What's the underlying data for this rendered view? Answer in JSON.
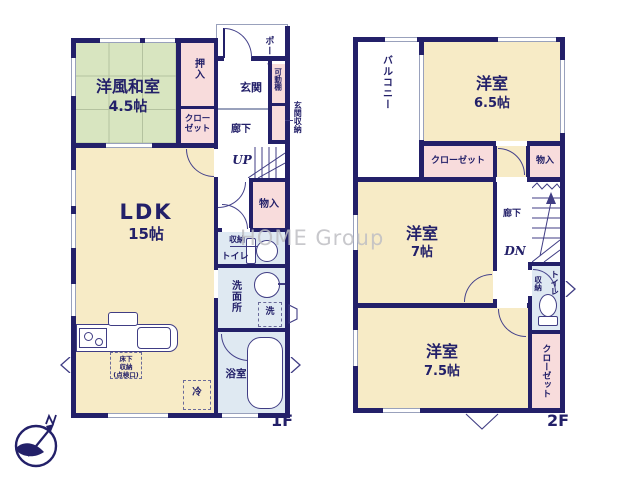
{
  "watermark": "HOME Group",
  "compass": {
    "north_label": "N"
  },
  "floor1": {
    "floor_label": "1F",
    "washitsu_name": "洋風和室",
    "washitsu_size": "4.5帖",
    "oshiire": "押入",
    "closet": "クローゼット",
    "genkan": "玄関",
    "porch": "ポーチ",
    "movable_shelf": "可動棚",
    "genkan_storage": "玄関収納",
    "hallway": "廊下",
    "stairs_up": "UP",
    "monoire": "物入",
    "ldk_name": "LDK",
    "ldk_size": "15帖",
    "storage": "収納",
    "toilet": "トイレ",
    "washroom": "洗面所",
    "laundry": "洗",
    "bathroom": "浴室",
    "underfloor_lines": [
      "床下",
      "収納",
      "(点検口)"
    ],
    "fridge": "冷"
  },
  "floor2": {
    "floor_label": "2F",
    "balcony": "バルコニー",
    "bedroom1_name": "洋室",
    "bedroom1_size": "6.5帖",
    "closet1": "クローゼット",
    "monoire": "物入",
    "bedroom2_name": "洋室",
    "bedroom2_size": "7帖",
    "hallway": "廊下",
    "stairs_down": "DN",
    "storage": "収納",
    "toilet": "トイレ",
    "closet2": "クローゼット",
    "bedroom3_name": "洋室",
    "bedroom3_size": "7.5帖"
  }
}
